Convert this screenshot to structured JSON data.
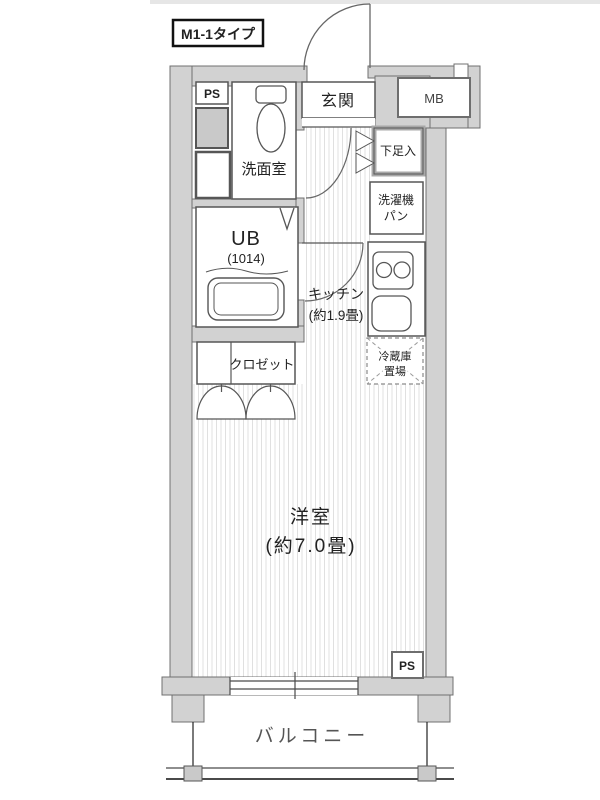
{
  "plan": {
    "title": "M1-1タイプ",
    "rooms": {
      "entrance": "玄関",
      "meter_box": "MB",
      "pipe_space_top": "PS",
      "pipe_space_bottom": "PS",
      "washroom": "洗面室",
      "shoe_cabinet": "下足入",
      "washer_pan_line1": "洗濯機",
      "washer_pan_line2": "パン",
      "unit_bath": "UB",
      "unit_bath_size": "(1014)",
      "kitchen": "キッチン",
      "kitchen_size": "(約1.9畳)",
      "fridge_line1": "冷蔵庫",
      "fridge_line2": "置場",
      "closet": "クロゼット",
      "western_room": "洋室",
      "western_room_size": "(約7.0畳)",
      "balcony": "バルコニー"
    },
    "colors": {
      "wall_fill": "#d2d2d2",
      "wall_outline": "#707070",
      "fixture_line": "#565656",
      "hatch_line": "#e0e0e0",
      "text": "#222222",
      "shade_box": "#c9c9c9"
    }
  }
}
